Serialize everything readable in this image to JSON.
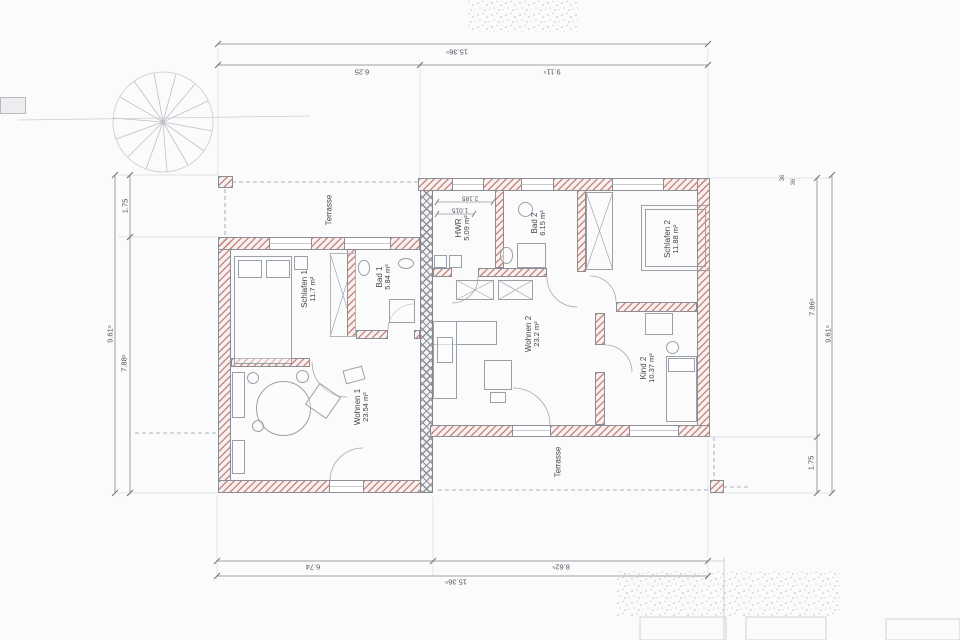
{
  "plan": {
    "rooms": [
      {
        "id": "schlafen1",
        "label": "Schlafen 1",
        "area": "11.7 m²"
      },
      {
        "id": "bad1",
        "label": "Bad 1",
        "area": "5.84 m²"
      },
      {
        "id": "wohnen1",
        "label": "Wohnen 1",
        "area": "23.54 m²"
      },
      {
        "id": "hwr",
        "label": "HWR",
        "area": "5.09 m²"
      },
      {
        "id": "bad2",
        "label": "Bad 2",
        "area": "6.15 m²"
      },
      {
        "id": "schlafen2",
        "label": "Schlafen 2",
        "area": "11.88 m²"
      },
      {
        "id": "wohnen2",
        "label": "Wohnen 2",
        "area": "23.2 m²"
      },
      {
        "id": "kind2",
        "label": "Kind 2",
        "area": "10.37 m²"
      }
    ],
    "terraces": [
      {
        "label": "Terrasse"
      },
      {
        "label": "Terrasse"
      }
    ],
    "dims": {
      "top_total": "15.36⁵",
      "top_left": "6.25",
      "top_right": "9.11⁵",
      "bottom_left": "6.74",
      "bottom_right": "8.62⁵",
      "bottom_total": "15.36⁵",
      "left_outer": "9.61⁵",
      "left_upper": "1.75",
      "left_lower": "7.88⁵",
      "right_inner_upper": "7.86⁵",
      "right_inner_lower": "1.75",
      "right_outer": "9.61⁵",
      "hwr_a": "2.185",
      "hwr_b": "1.015",
      "wall_a": "36",
      "wall_b": "36"
    },
    "colors": {
      "wall_hatch": "#bd7972",
      "party_wall": "#8f8f97",
      "line": "#9a9aa2",
      "text": "#45454e"
    }
  }
}
